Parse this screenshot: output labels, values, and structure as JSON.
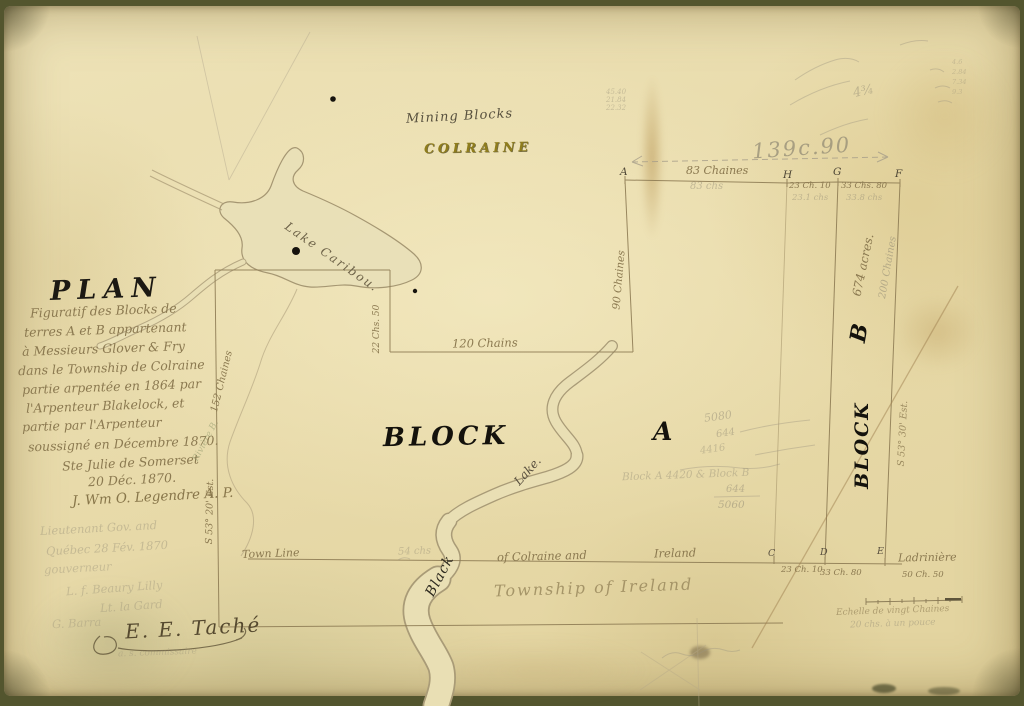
{
  "palette": {
    "paper": "#ece1b4",
    "ink": "#26221a",
    "brown_ink": "#8b7950",
    "pencil": "#9a9180",
    "title_olive": "#94821e"
  },
  "header": {
    "subtitle": "Mining Blocks",
    "township": "COLRAINE"
  },
  "title_block": {
    "heading": "PLAN",
    "lines": [
      "Figuratif des Blocks de",
      "terres A et B appartenant",
      "à Messieurs Glover & Fry",
      "dans le Township de Colraine",
      "partie arpentée en 1864 par",
      "l'Arpenteur Blakelock, et",
      "partie par l'Arpenteur",
      "soussigné en Décembre 1870.",
      "Ste Julie de Somerset",
      "20 Déc. 1870."
    ],
    "surveyor_signature": "J. Wm O. Legendre A. P.",
    "pencil_lines": [
      "Lieutenant Gov. and",
      "Québec 28 Fév. 1870",
      "gouverneur",
      "L. f. Beaury Lilly",
      "Lt. la Gard",
      "G. Barra"
    ],
    "approval_signature": "E. E. Taché",
    "approval_note": "a. s. commissaire"
  },
  "map": {
    "block_a": {
      "word": "BLOCK",
      "letter": "A"
    },
    "block_b": {
      "word": "BLOCK",
      "letter": "B",
      "area": "674 acres.",
      "length_pencil": "200 Chaines",
      "bearing": "S 53° 30' Est."
    },
    "west": {
      "bearing": "S 53° 20' Est.",
      "length": "152 Chaines",
      "river_pencil": "Rivière B."
    },
    "north_inner": {
      "offset": "22 Chs. 50",
      "line": "120 Chains",
      "east": "90 Chaines"
    },
    "top_line": {
      "overall": "139c.90",
      "pt_a": "A",
      "pt_h": "H",
      "pt_g": "G",
      "pt_f": "F",
      "seg1": "83 Chaines",
      "seg1_pencil": "83 chs",
      "seg2": "23 Ch. 10",
      "seg2_pencil": "23.1 chs",
      "seg3": "33 Chs. 80",
      "seg3_pencil": "33.8 chs"
    },
    "bottom_line": {
      "town_line": "Town Line",
      "pencil": "54 chs",
      "colraine": "of Colraine and",
      "ireland": "Ireland",
      "township": "Township of Ireland",
      "pt_c": "C",
      "pt_d": "D",
      "pt_e": "E",
      "seg1": "23 Ch. 10",
      "seg2": "33 Ch. 80",
      "seg3": "50 Ch. 50",
      "place": "Ladrinière"
    },
    "water": {
      "lake_caribou": "Lake Caribou.",
      "lake": "Lake.",
      "creek": "Black"
    }
  },
  "scale": {
    "line1": "Echelle de vingt Chaines",
    "line2": "20 chs. à un pouce"
  },
  "pencil_notes": {
    "corner": "4¾",
    "col_left": [
      "45.40",
      "21.84",
      "22.32"
    ],
    "col_right": [
      "4.6",
      "2.84",
      "7.34",
      "9.3"
    ],
    "calc": [
      "5080",
      "644",
      "4416"
    ],
    "block_note": "Block A 4420 & Block B",
    "frac_top": "644",
    "frac_bottom": "5060"
  }
}
